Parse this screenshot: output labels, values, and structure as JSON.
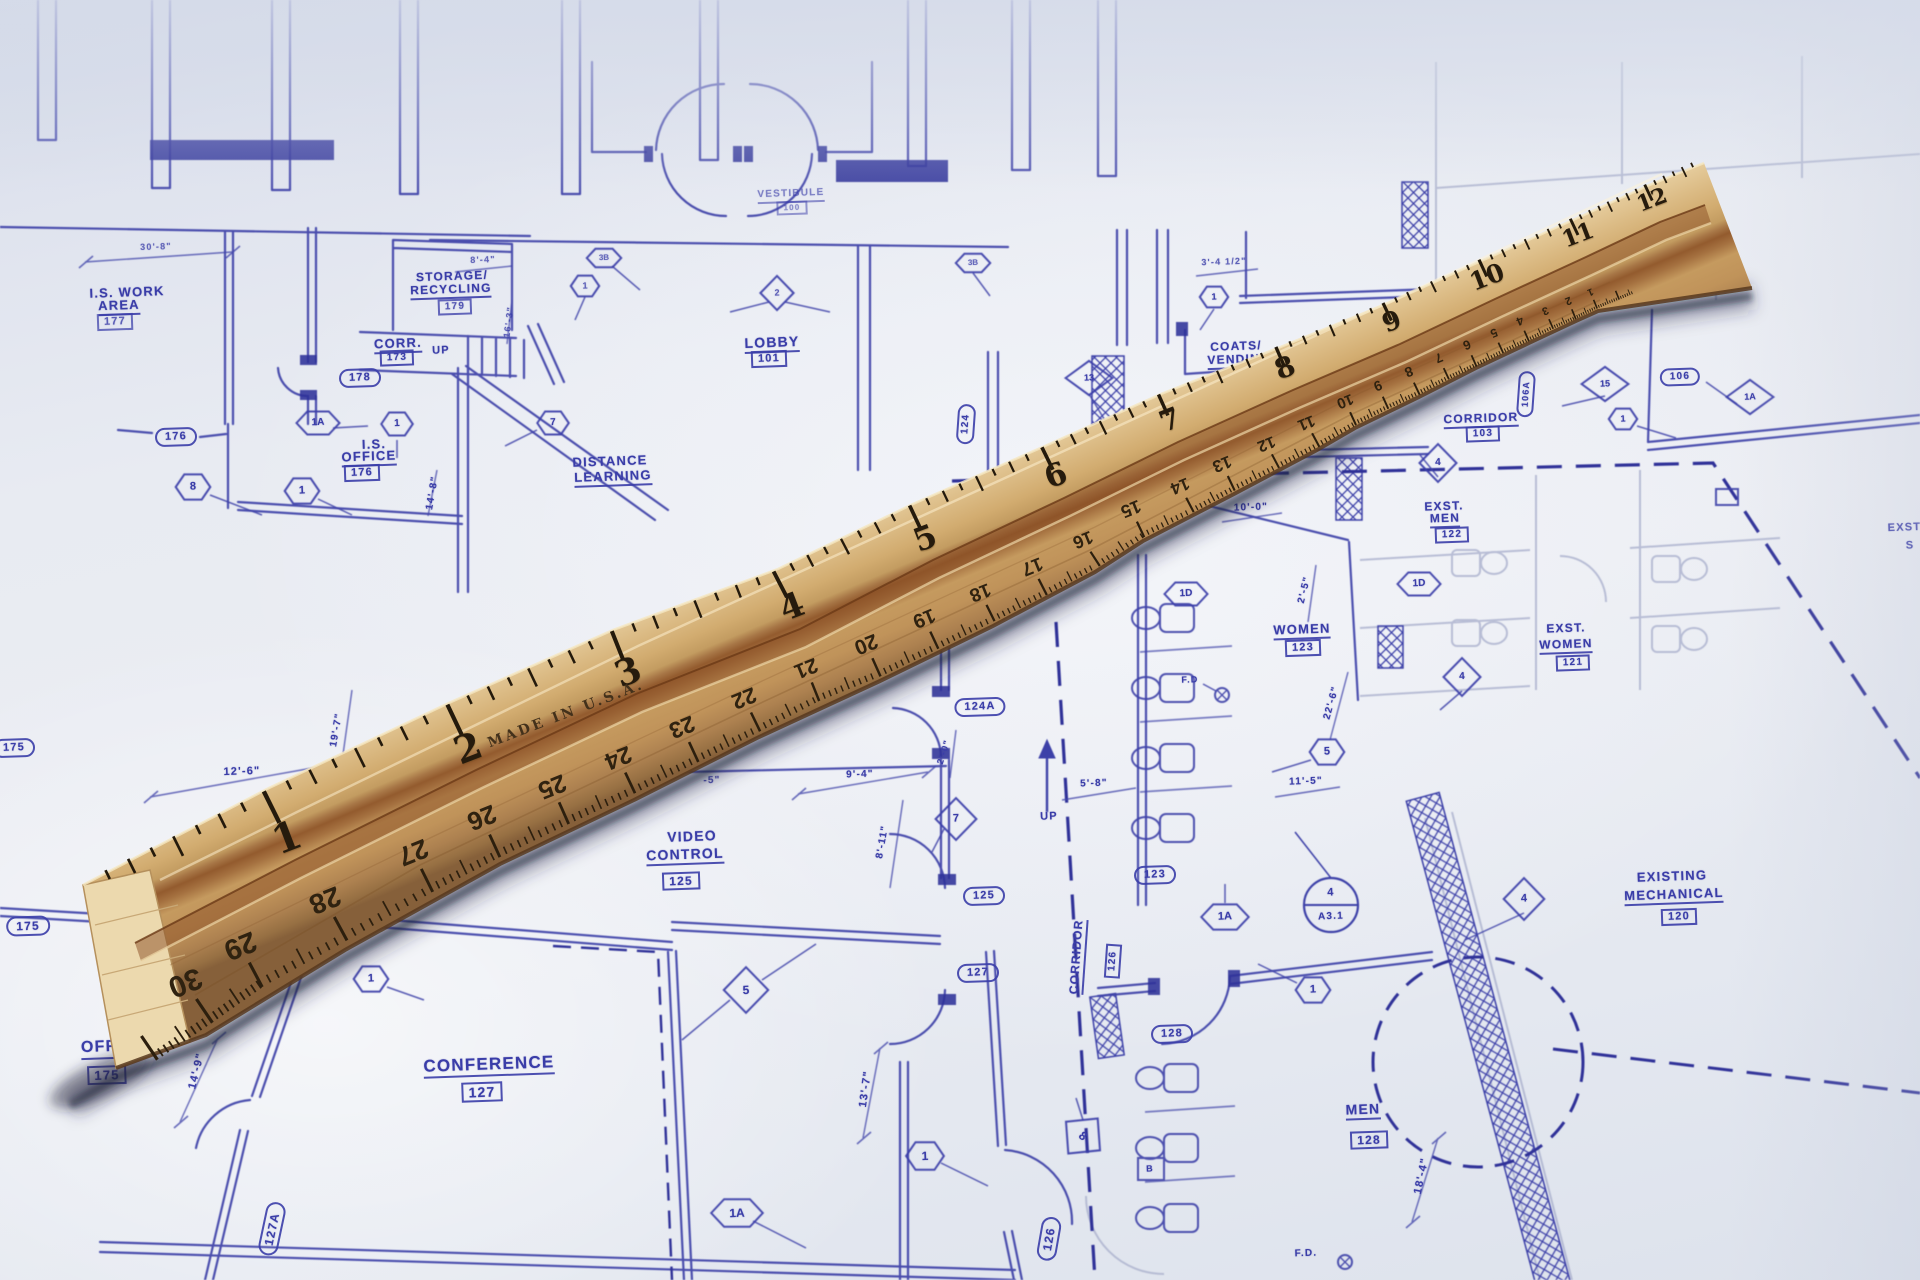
{
  "colors": {
    "ink": "#3a3da8",
    "ink_bold": "#2e3198",
    "ink_light": "#9aa0c9",
    "paper": "#e8ebf2",
    "wood_light": "#e6cd9e",
    "wood_mid": "#d2ac70",
    "wood_groove": "#8f5226",
    "tick": "#241a0c",
    "shadow": "rgba(35,42,75,0.4)"
  },
  "plan": {
    "labels": [
      {
        "k": "t",
        "t": "I.S. WORK",
        "x": 127,
        "y": 292,
        "s": 13
      },
      {
        "k": "tu",
        "t": "AREA",
        "x": 119,
        "y": 307,
        "s": 13
      },
      {
        "k": "box",
        "t": "177",
        "x": 115,
        "y": 322,
        "s": 11,
        "o": 0.8
      },
      {
        "k": "t",
        "t": "30'-8\"",
        "x": 156,
        "y": 247,
        "s": 9,
        "o": 0.75
      },
      {
        "k": "t",
        "t": "STORAGE/",
        "x": 452,
        "y": 276,
        "s": 12
      },
      {
        "k": "tu",
        "t": "RECYCLING",
        "x": 451,
        "y": 291,
        "s": 12
      },
      {
        "k": "box",
        "t": "179",
        "x": 455,
        "y": 307,
        "s": 10,
        "o": 0.85
      },
      {
        "k": "tu",
        "t": "CORR.",
        "x": 398,
        "y": 345,
        "s": 13
      },
      {
        "k": "box",
        "t": "173",
        "x": 397,
        "y": 358,
        "s": 10
      },
      {
        "k": "t",
        "t": "UP",
        "x": 441,
        "y": 351,
        "s": 11
      },
      {
        "k": "pill",
        "t": "178",
        "x": 360,
        "y": 378,
        "s": 11
      },
      {
        "k": "t",
        "t": "I.S.",
        "x": 374,
        "y": 444,
        "s": 13
      },
      {
        "k": "tu",
        "t": "OFFICE",
        "x": 369,
        "y": 458,
        "s": 13
      },
      {
        "k": "box",
        "t": "176",
        "x": 362,
        "y": 473,
        "s": 11
      },
      {
        "k": "pill",
        "t": "176",
        "x": 176,
        "y": 437,
        "s": 11
      },
      {
        "k": "hex",
        "t": "8",
        "x": 193,
        "y": 487,
        "s": 11
      },
      {
        "k": "hex",
        "t": "1",
        "x": 302,
        "y": 491,
        "s": 11
      },
      {
        "k": "hex",
        "t": "1A",
        "x": 318,
        "y": 423,
        "s": 10
      },
      {
        "k": "hex",
        "t": "1",
        "x": 397,
        "y": 424,
        "s": 10
      },
      {
        "k": "hex",
        "t": "7",
        "x": 553,
        "y": 423,
        "s": 10
      },
      {
        "k": "t",
        "t": "8'-4\"",
        "x": 483,
        "y": 260,
        "s": 9,
        "o": 0.75
      },
      {
        "k": "t",
        "t": "16'-3\"",
        "x": 509,
        "y": 322,
        "s": 9,
        "r": -83,
        "o": 0.8
      },
      {
        "k": "t",
        "t": "14'-8\"",
        "x": 433,
        "y": 493,
        "s": 10,
        "r": -80
      },
      {
        "k": "tu",
        "t": "LOBBY",
        "x": 772,
        "y": 344,
        "s": 14
      },
      {
        "k": "box",
        "t": "101",
        "x": 769,
        "y": 359,
        "s": 11
      },
      {
        "k": "tu",
        "t": "VESTIBULE",
        "x": 791,
        "y": 196,
        "s": 10,
        "o": 0.6
      },
      {
        "k": "box",
        "t": "100",
        "x": 792,
        "y": 208,
        "s": 8,
        "o": 0.55
      },
      {
        "k": "hex",
        "t": "1",
        "x": 585,
        "y": 286,
        "s": 9,
        "o": 0.8
      },
      {
        "k": "hex",
        "t": "3B",
        "x": 604,
        "y": 258,
        "s": 8,
        "o": 0.75
      },
      {
        "k": "hex",
        "t": "3B",
        "x": 973,
        "y": 263,
        "s": 8,
        "o": 0.75
      },
      {
        "k": "dia",
        "t": "2",
        "x": 777,
        "y": 293,
        "s": 9,
        "o": 0.8
      },
      {
        "k": "t",
        "t": "DISTANCE",
        "x": 610,
        "y": 461,
        "s": 13
      },
      {
        "k": "tu",
        "t": "LEARNING",
        "x": 613,
        "y": 478,
        "s": 13
      },
      {
        "k": "pill",
        "t": "124",
        "x": 966,
        "y": 424,
        "s": 10,
        "r": -86
      },
      {
        "k": "dia",
        "t": "13",
        "x": 1089,
        "y": 378,
        "s": 9
      },
      {
        "k": "t",
        "t": "COATS/",
        "x": 1236,
        "y": 346,
        "s": 12
      },
      {
        "k": "tu",
        "t": "VENDING",
        "x": 1239,
        "y": 361,
        "s": 12
      },
      {
        "k": "t",
        "t": "3'-4 1/2\"",
        "x": 1224,
        "y": 262,
        "s": 9,
        "o": 0.8
      },
      {
        "k": "hex",
        "t": "1",
        "x": 1214,
        "y": 297,
        "s": 9
      },
      {
        "k": "tu",
        "t": "CORRIDOR",
        "x": 1481,
        "y": 420,
        "s": 12
      },
      {
        "k": "box",
        "t": "103",
        "x": 1483,
        "y": 434,
        "s": 10
      },
      {
        "k": "pill",
        "t": "106",
        "x": 1680,
        "y": 377,
        "s": 10
      },
      {
        "k": "pill",
        "t": "106A",
        "x": 1526,
        "y": 394,
        "s": 9,
        "r": -86
      },
      {
        "k": "dia",
        "t": "15",
        "x": 1605,
        "y": 384,
        "s": 9
      },
      {
        "k": "dia",
        "t": "1A",
        "x": 1750,
        "y": 397,
        "s": 9
      },
      {
        "k": "hex",
        "t": "1",
        "x": 1623,
        "y": 419,
        "s": 9
      },
      {
        "k": "dia",
        "t": "4",
        "x": 1438,
        "y": 463,
        "s": 10
      },
      {
        "k": "t",
        "t": "EXST.",
        "x": 1444,
        "y": 506,
        "s": 12
      },
      {
        "k": "tu",
        "t": "MEN",
        "x": 1445,
        "y": 520,
        "s": 12
      },
      {
        "k": "box",
        "t": "122",
        "x": 1452,
        "y": 535,
        "s": 10
      },
      {
        "k": "t",
        "t": "10'-0\"",
        "x": 1251,
        "y": 508,
        "s": 10
      },
      {
        "k": "hex",
        "t": "1D",
        "x": 1186,
        "y": 594,
        "s": 10
      },
      {
        "k": "hex",
        "t": "1D",
        "x": 1419,
        "y": 584,
        "s": 10
      },
      {
        "k": "t",
        "t": "2'-5\"",
        "x": 1305,
        "y": 590,
        "s": 10,
        "r": -76
      },
      {
        "k": "tu",
        "t": "WOMEN",
        "x": 1302,
        "y": 631,
        "s": 13
      },
      {
        "k": "box",
        "t": "123",
        "x": 1303,
        "y": 648,
        "s": 11
      },
      {
        "k": "t",
        "t": "F.D",
        "x": 1190,
        "y": 680,
        "s": 9
      },
      {
        "k": "t",
        "t": "EXST.",
        "x": 1566,
        "y": 628,
        "s": 12
      },
      {
        "k": "tu",
        "t": "WOMEN",
        "x": 1566,
        "y": 646,
        "s": 12
      },
      {
        "k": "box",
        "t": "121",
        "x": 1573,
        "y": 663,
        "s": 10
      },
      {
        "k": "dia",
        "t": "4",
        "x": 1462,
        "y": 677,
        "s": 10
      },
      {
        "k": "t",
        "t": "22'-6\"",
        "x": 1332,
        "y": 703,
        "s": 10,
        "r": -74
      },
      {
        "k": "hex",
        "t": "5",
        "x": 1327,
        "y": 752,
        "s": 11
      },
      {
        "k": "t",
        "t": "11'-5\"",
        "x": 1306,
        "y": 782,
        "s": 10
      },
      {
        "k": "t",
        "t": "EXST.",
        "x": 1906,
        "y": 528,
        "s": 11,
        "o": 0.9
      },
      {
        "k": "t",
        "t": "S",
        "x": 1910,
        "y": 546,
        "s": 11,
        "o": 0.9
      },
      {
        "k": "t",
        "t": "12'-6\"",
        "x": 242,
        "y": 772,
        "s": 11
      },
      {
        "k": "t",
        "t": "19'-7\"",
        "x": 337,
        "y": 730,
        "s": 10,
        "r": -80
      },
      {
        "k": "pill",
        "t": "175",
        "x": 14,
        "y": 748,
        "s": 11
      },
      {
        "k": "t",
        "t": "9'-4\"",
        "x": 860,
        "y": 775,
        "s": 10
      },
      {
        "k": "t",
        "t": "2'-0\"",
        "x": 944,
        "y": 752,
        "s": 9,
        "r": -72
      },
      {
        "k": "t",
        "t": "8'-11\"",
        "x": 883,
        "y": 842,
        "s": 10,
        "r": -80
      },
      {
        "k": "t",
        "t": "-5\"",
        "x": 712,
        "y": 781,
        "s": 10,
        "o": 0.85
      },
      {
        "k": "t",
        "t": "5'-8\"",
        "x": 1094,
        "y": 784,
        "s": 10
      },
      {
        "k": "t",
        "t": "UP",
        "x": 1049,
        "y": 817,
        "s": 11
      },
      {
        "k": "pill",
        "t": "124A",
        "x": 980,
        "y": 707,
        "s": 11
      },
      {
        "k": "dia",
        "t": "7",
        "x": 956,
        "y": 819,
        "s": 11
      },
      {
        "k": "t",
        "t": "VIDEO",
        "x": 692,
        "y": 836,
        "s": 14
      },
      {
        "k": "tu",
        "t": "CONTROL",
        "x": 685,
        "y": 856,
        "s": 14
      },
      {
        "k": "box",
        "t": "125",
        "x": 681,
        "y": 881,
        "s": 12
      },
      {
        "k": "pill",
        "t": "125",
        "x": 984,
        "y": 896,
        "s": 11
      },
      {
        "k": "pill",
        "t": "123",
        "x": 1155,
        "y": 875,
        "s": 11
      },
      {
        "k": "hex",
        "t": "1A",
        "x": 1225,
        "y": 917,
        "s": 11
      },
      {
        "k": "pill",
        "t": "127",
        "x": 978,
        "y": 973,
        "s": 11
      },
      {
        "k": "pill",
        "t": "175",
        "x": 28,
        "y": 926,
        "s": 12
      },
      {
        "k": "t",
        "t": "I.S.",
        "x": 124,
        "y": 1021,
        "s": 16
      },
      {
        "k": "tu",
        "t": "OFFICE",
        "x": 114,
        "y": 1049,
        "s": 16
      },
      {
        "k": "box",
        "t": "175",
        "x": 107,
        "y": 1075,
        "s": 13
      },
      {
        "k": "t",
        "t": "14'-9\"",
        "x": 197,
        "y": 1071,
        "s": 11,
        "r": -76
      },
      {
        "k": "hex",
        "t": "1",
        "x": 371,
        "y": 979,
        "s": 11
      },
      {
        "k": "dia",
        "t": "5",
        "x": 746,
        "y": 990,
        "s": 12
      },
      {
        "k": "tu",
        "t": "CONFERENCE",
        "x": 489,
        "y": 1066,
        "s": 17
      },
      {
        "k": "box",
        "t": "127",
        "x": 482,
        "y": 1092,
        "s": 14
      },
      {
        "k": "t",
        "t": "13'-7\"",
        "x": 866,
        "y": 1089,
        "s": 11,
        "r": -82
      },
      {
        "k": "hex",
        "t": "1",
        "x": 925,
        "y": 1156,
        "s": 12
      },
      {
        "k": "hex",
        "t": "1A",
        "x": 737,
        "y": 1213,
        "s": 12
      },
      {
        "k": "pill",
        "t": "127A",
        "x": 272,
        "y": 1229,
        "s": 12,
        "r": -78
      },
      {
        "k": "tu",
        "t": "CORRIDOR",
        "x": 1078,
        "y": 957,
        "s": 12,
        "r": -86
      },
      {
        "k": "box",
        "t": "126",
        "x": 1113,
        "y": 961,
        "s": 10,
        "r": -86
      },
      {
        "k": "pill",
        "t": "126",
        "x": 1049,
        "y": 1239,
        "s": 12,
        "r": -80
      },
      {
        "k": "hex",
        "t": "1",
        "x": 1313,
        "y": 990,
        "s": 11
      },
      {
        "k": "dia",
        "t": "8",
        "x": 1083,
        "y": 1136,
        "s": 12,
        "r": 40
      },
      {
        "k": "t",
        "t": "B",
        "x": 1150,
        "y": 1169,
        "s": 9
      },
      {
        "k": "pill",
        "t": "128",
        "x": 1172,
        "y": 1034,
        "s": 11
      },
      {
        "k": "tu",
        "t": "MEN",
        "x": 1363,
        "y": 1111,
        "s": 14
      },
      {
        "k": "box",
        "t": "128",
        "x": 1369,
        "y": 1140,
        "s": 12
      },
      {
        "k": "t",
        "t": "18'-4\"",
        "x": 1422,
        "y": 1176,
        "s": 11,
        "r": -78
      },
      {
        "k": "t",
        "t": "F.D.",
        "x": 1306,
        "y": 1254,
        "s": 10
      },
      {
        "k": "dia",
        "t": "4",
        "x": 1524,
        "y": 899,
        "s": 11
      },
      {
        "k": "t",
        "t": "EXISTING",
        "x": 1672,
        "y": 876,
        "s": 13
      },
      {
        "k": "tu",
        "t": "MECHANICAL",
        "x": 1674,
        "y": 896,
        "s": 13
      },
      {
        "k": "box",
        "t": "120",
        "x": 1679,
        "y": 917,
        "s": 11
      },
      {
        "k": "t",
        "t": "4",
        "x": 1331,
        "y": 893,
        "s": 11
      },
      {
        "k": "t",
        "t": "A3.1",
        "x": 1331,
        "y": 917,
        "s": 10
      }
    ]
  },
  "ruler": {
    "made_in": {
      "k": "rt",
      "t": "MADE IN U.S.A.",
      "x": 566,
      "y": 714,
      "s": 14,
      "r": -21
    },
    "inch_numbers": [
      {
        "k": "inch",
        "t": "1",
        "x": 287,
        "y": 838,
        "s": 40,
        "e": 50
      },
      {
        "k": "inch",
        "t": "2",
        "x": 468,
        "y": 748,
        "s": 38,
        "e": 46
      },
      {
        "k": "inch",
        "t": "3",
        "x": 628,
        "y": 672,
        "s": 36,
        "e": 42
      },
      {
        "k": "inch",
        "t": "4",
        "x": 792,
        "y": 607,
        "s": 34,
        "e": 38
      },
      {
        "k": "inch",
        "t": "5",
        "x": 925,
        "y": 538,
        "s": 32,
        "e": 34
      },
      {
        "k": "inch",
        "t": "6",
        "x": 1056,
        "y": 476,
        "s": 31,
        "e": 30
      },
      {
        "k": "inch",
        "t": "7",
        "x": 1170,
        "y": 420,
        "s": 29,
        "e": 26
      },
      {
        "k": "inch",
        "t": "8",
        "x": 1285,
        "y": 368,
        "s": 28,
        "e": 21
      },
      {
        "k": "inch",
        "t": "9",
        "x": 1392,
        "y": 322,
        "s": 26,
        "e": 19
      },
      {
        "k": "inch",
        "t": "10",
        "x": 1487,
        "y": 277,
        "s": 25,
        "e": 17
      },
      {
        "k": "inch",
        "t": "11",
        "x": 1578,
        "y": 235,
        "s": 23,
        "e": 16
      },
      {
        "k": "inch",
        "t": "12",
        "x": 1652,
        "y": 200,
        "s": 22,
        "e": 15
      }
    ],
    "cm_numbers": [
      {
        "k": "cm",
        "t": "30",
        "x": 185,
        "y": 982,
        "s": 30
      },
      {
        "k": "cm",
        "t": "29",
        "x": 240,
        "y": 945,
        "s": 29
      },
      {
        "k": "cm",
        "t": "28",
        "x": 325,
        "y": 900,
        "s": 28
      },
      {
        "k": "cm",
        "t": "27",
        "x": 413,
        "y": 852,
        "s": 27
      },
      {
        "k": "cm",
        "t": "26",
        "x": 482,
        "y": 818,
        "s": 26
      },
      {
        "k": "cm",
        "t": "25",
        "x": 552,
        "y": 786,
        "s": 25
      },
      {
        "k": "cm",
        "t": "24",
        "x": 618,
        "y": 757,
        "s": 24
      },
      {
        "k": "cm",
        "t": "23",
        "x": 682,
        "y": 727,
        "s": 23
      },
      {
        "k": "cm",
        "t": "22",
        "x": 744,
        "y": 698,
        "s": 22
      },
      {
        "k": "cm",
        "t": "21",
        "x": 806,
        "y": 668,
        "s": 21
      },
      {
        "k": "cm",
        "t": "20",
        "x": 866,
        "y": 644,
        "s": 21
      },
      {
        "k": "cm",
        "t": "19",
        "x": 924,
        "y": 618,
        "s": 20
      },
      {
        "k": "cm",
        "t": "18",
        "x": 980,
        "y": 592,
        "s": 19
      },
      {
        "k": "cm",
        "t": "17",
        "x": 1032,
        "y": 566,
        "s": 19
      },
      {
        "k": "cm",
        "t": "16",
        "x": 1083,
        "y": 540,
        "s": 18
      },
      {
        "k": "cm",
        "t": "15",
        "x": 1131,
        "y": 509,
        "s": 18
      },
      {
        "k": "cm",
        "t": "14",
        "x": 1180,
        "y": 486,
        "s": 17
      },
      {
        "k": "cm",
        "t": "13",
        "x": 1222,
        "y": 464,
        "s": 17
      },
      {
        "k": "cm",
        "t": "12",
        "x": 1266,
        "y": 443,
        "s": 16
      },
      {
        "k": "cm",
        "t": "11",
        "x": 1306,
        "y": 422,
        "s": 16
      },
      {
        "k": "cm",
        "t": "10",
        "x": 1345,
        "y": 401,
        "s": 15
      },
      {
        "k": "cm",
        "t": "9",
        "x": 1378,
        "y": 386,
        "s": 14
      },
      {
        "k": "cm",
        "t": "8",
        "x": 1409,
        "y": 372,
        "s": 14
      },
      {
        "k": "cm",
        "t": "7",
        "x": 1439,
        "y": 358,
        "s": 13
      },
      {
        "k": "cm",
        "t": "6",
        "x": 1467,
        "y": 345,
        "s": 13
      },
      {
        "k": "cm",
        "t": "5",
        "x": 1494,
        "y": 333,
        "s": 12
      },
      {
        "k": "cm",
        "t": "4",
        "x": 1520,
        "y": 321,
        "s": 12
      },
      {
        "k": "cm",
        "t": "3",
        "x": 1545,
        "y": 310,
        "s": 11
      },
      {
        "k": "cm",
        "t": "2",
        "x": 1568,
        "y": 300,
        "s": 11
      },
      {
        "k": "cm",
        "t": "1",
        "x": 1590,
        "y": 291,
        "s": 10
      }
    ]
  }
}
